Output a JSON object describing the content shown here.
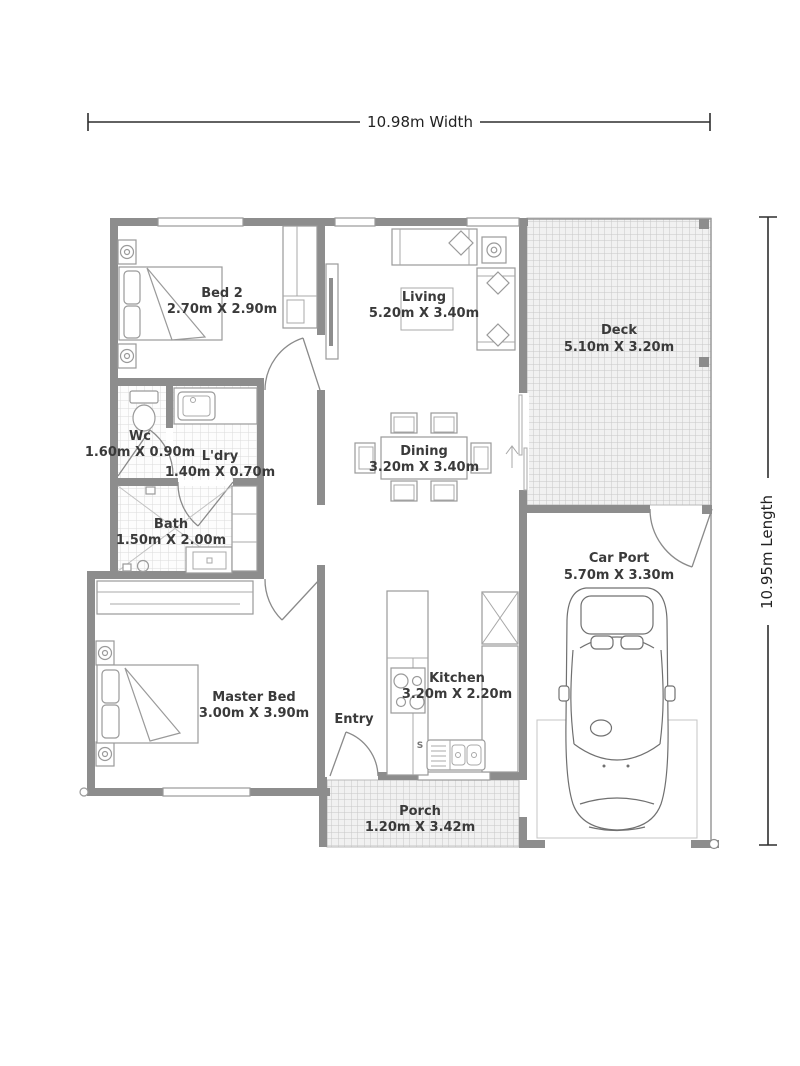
{
  "dimensions": {
    "width_label": "10.98m Width",
    "length_label": "10.95m Length"
  },
  "rooms": {
    "bed2": {
      "name": "Bed 2",
      "size": "2.70m X 2.90m"
    },
    "living": {
      "name": "Living",
      "size": "5.20m X 3.40m"
    },
    "deck": {
      "name": "Deck",
      "size": "5.10m X 3.20m"
    },
    "wc": {
      "name": "Wc",
      "size": "1.60m X 0.90m"
    },
    "ldry": {
      "name": "L'dry",
      "size": "1.40m X 0.70m"
    },
    "bath": {
      "name": "Bath",
      "size": "1.50m X 2.00m"
    },
    "dining": {
      "name": "Dining",
      "size": "3.20m X 3.40m"
    },
    "carport": {
      "name": "Car Port",
      "size": "5.70m X 3.30m"
    },
    "master": {
      "name": "Master Bed",
      "size": "3.00m X 3.90m"
    },
    "kitchen": {
      "name": "Kitchen",
      "size": "3.20m X 2.20m"
    },
    "entry": {
      "name": "Entry"
    },
    "porch": {
      "name": "Porch",
      "size": "1.20m X 3.42m"
    }
  },
  "annotations": {
    "sink_label": "S"
  },
  "colors": {
    "wall": "#8d8d8d",
    "line": "#9a9a9a",
    "text": "#3a3a3a",
    "hatch": "#c7c7c7",
    "hatch_bg": "#f1f1f1"
  }
}
